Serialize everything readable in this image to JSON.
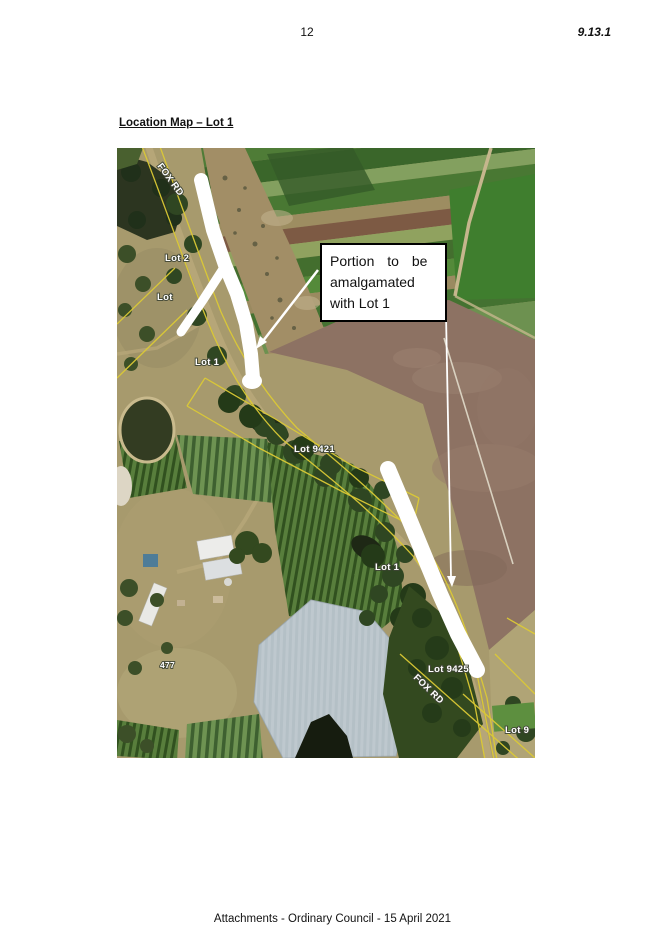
{
  "page": {
    "number": "12",
    "agenda_reference": "9.13.1",
    "heading": "Location Map – Lot 1",
    "footer": "Attachments - Ordinary Council - 15 April 2021"
  },
  "map": {
    "callout": {
      "line1": "Portion to be",
      "line2": "amalgamated",
      "line3": "with Lot 1"
    },
    "labels": {
      "fox_rd_upper": "FOX RD",
      "lot_2": "Lot 2",
      "lot_partial": "Lot",
      "lot_1_upper": "Lot 1",
      "lot_9421": "Lot 9421",
      "lot_1_mid": "Lot 1",
      "lot_9425": "Lot 9425",
      "fox_rd_lower": "FOX RD",
      "lot_9_partial": "Lot 9",
      "house_number": "477"
    },
    "colors": {
      "field_green": "#497833",
      "paddock_brown": "#8d7263",
      "tree_dark": "#2f4622",
      "cadastral_yellow": "#dcca35",
      "highlight_white": "#ffffff",
      "netting_gray": "#bac4ca"
    }
  }
}
